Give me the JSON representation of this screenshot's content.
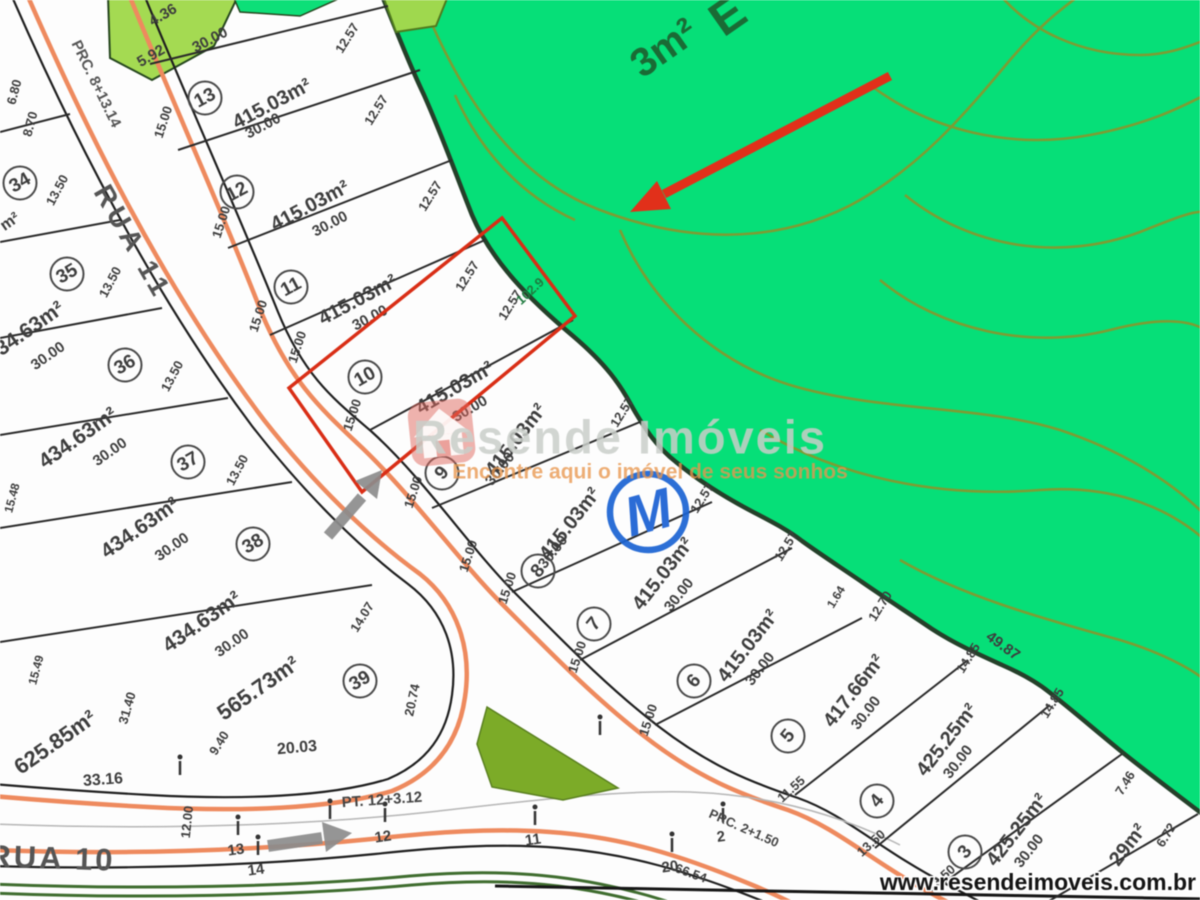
{
  "footer": {
    "url": "www.resendeimoveis.com.br"
  },
  "watermark": {
    "brand": "Resende Imóveis",
    "tagline": "Encontre aqui o imóvel de seus sonhos",
    "icon": "house-icon"
  },
  "colors": {
    "preserve_green": "#06DF78",
    "light_green_lot": "#A4DA52",
    "contour_olive": "#7E9C33",
    "island_green": "#7CAB28",
    "road_salmon": "#EE8A5E",
    "highlight_red": "#D92E16",
    "marker_blue": "#1A63D2",
    "arrow_gray": "#8C8C8C"
  },
  "map": {
    "streets": [
      {
        "name": "RUA 11"
      },
      {
        "name": "RUA 10"
      }
    ],
    "stations": [
      {
        "text": "PRC. 8+13.14"
      },
      {
        "text": "PT. 12+3.12"
      },
      {
        "text": "PRC. 2+1.50"
      }
    ],
    "green_labels": {
      "letter": "E",
      "fragment": "3m²",
      "frontage": "102.9"
    },
    "monument_label": "M",
    "lots": [
      {
        "num": "13",
        "area": "415.03m²",
        "circle": {
          "x": 205,
          "y": 98,
          "rot": -28
        },
        "label": {
          "x": 272,
          "y": 104,
          "rot": -28,
          "s": 20
        }
      },
      {
        "num": "12",
        "area": "415.03m²",
        "circle": {
          "x": 237,
          "y": 192,
          "rot": -28
        },
        "label": {
          "x": 310,
          "y": 206,
          "rot": -28,
          "s": 20
        }
      },
      {
        "num": "11",
        "area": "415.03m²",
        "circle": {
          "x": 291,
          "y": 287,
          "rot": -28
        },
        "label": {
          "x": 358,
          "y": 300,
          "rot": -28,
          "s": 20
        }
      },
      {
        "num": "10",
        "area": "415.03m²",
        "circle": {
          "x": 365,
          "y": 377,
          "rot": -30
        },
        "label": {
          "x": 455,
          "y": 388,
          "rot": -30,
          "s": 20
        }
      },
      {
        "num": "9",
        "area": "415.03m²",
        "circle": {
          "x": 442,
          "y": 473,
          "rot": -50
        },
        "label": {
          "x": 516,
          "y": 440,
          "rot": -52,
          "s": 20
        }
      },
      {
        "num": "8",
        "area": "415.03m²",
        "circle": {
          "x": 538,
          "y": 571,
          "rot": -50
        },
        "label": {
          "x": 570,
          "y": 524,
          "rot": -52,
          "s": 20
        }
      },
      {
        "num": "7",
        "area": "415.03m²",
        "circle": {
          "x": 594,
          "y": 624,
          "rot": -50
        },
        "label": {
          "x": 663,
          "y": 574,
          "rot": -52,
          "s": 20
        }
      },
      {
        "num": "6",
        "area": "415.03m²",
        "circle": {
          "x": 694,
          "y": 681,
          "rot": -50
        },
        "label": {
          "x": 748,
          "y": 646,
          "rot": -52,
          "s": 20
        }
      },
      {
        "num": "5",
        "area": "417.66m²",
        "circle": {
          "x": 788,
          "y": 736,
          "rot": -50
        },
        "label": {
          "x": 854,
          "y": 691,
          "rot": -52,
          "s": 20
        }
      },
      {
        "num": "4",
        "area": "425.25m²",
        "circle": {
          "x": 877,
          "y": 801,
          "rot": -50
        },
        "label": {
          "x": 947,
          "y": 740,
          "rot": -52,
          "s": 20
        }
      },
      {
        "num": "3",
        "area": "425.25m²",
        "circle": {
          "x": 965,
          "y": 852,
          "rot": -50
        },
        "label": {
          "x": 1017,
          "y": 830,
          "rot": -52,
          "s": 20
        }
      },
      {
        "num": "34",
        "area": "",
        "circle": {
          "x": 20,
          "y": 183,
          "rot": -30
        },
        "label": null
      },
      {
        "num": "35",
        "area": "434.63m²",
        "circle": {
          "x": 67,
          "y": 274,
          "rot": -30
        },
        "label": {
          "x": 25,
          "y": 332,
          "rot": -35,
          "s": 21
        }
      },
      {
        "num": "36",
        "area": "434.63m²",
        "circle": {
          "x": 125,
          "y": 365,
          "rot": -30
        },
        "label": {
          "x": 78,
          "y": 438,
          "rot": -35,
          "s": 21
        }
      },
      {
        "num": "37",
        "area": "434.63m²",
        "circle": {
          "x": 188,
          "y": 462,
          "rot": -30
        },
        "label": {
          "x": 140,
          "y": 528,
          "rot": -35,
          "s": 21
        }
      },
      {
        "num": "38",
        "area": "434.63m²",
        "circle": {
          "x": 253,
          "y": 544,
          "rot": -30
        },
        "label": {
          "x": 202,
          "y": 622,
          "rot": -35,
          "s": 21
        }
      },
      {
        "num": "39",
        "area": "565.73m²",
        "circle": {
          "x": 360,
          "y": 681,
          "rot": -30
        },
        "label": {
          "x": 258,
          "y": 688,
          "rot": -35,
          "s": 22
        }
      }
    ],
    "extra_areas": [
      {
        "t": "625.85m²",
        "x": 55,
        "y": 742,
        "r": -35,
        "s": 22
      },
      {
        "t": "29m²",
        "x": 1128,
        "y": 845,
        "r": -52,
        "s": 20
      },
      {
        "t": "m²",
        "x": 10,
        "y": 222,
        "r": -35,
        "s": 16
      }
    ],
    "measurements": [
      {
        "t": "15.00",
        "x": 163,
        "y": 122,
        "r": -72
      },
      {
        "t": "15.00",
        "x": 221,
        "y": 222,
        "r": -72
      },
      {
        "t": "15.00",
        "x": 258,
        "y": 316,
        "r": -72
      },
      {
        "t": "15.00",
        "x": 297,
        "y": 347,
        "r": -72
      },
      {
        "t": "15.00",
        "x": 352,
        "y": 415,
        "r": -72
      },
      {
        "t": "15.00",
        "x": 413,
        "y": 492,
        "r": -72
      },
      {
        "t": "15.00",
        "x": 468,
        "y": 556,
        "r": -72
      },
      {
        "t": "15.00",
        "x": 507,
        "y": 588,
        "r": -72
      },
      {
        "t": "15.00",
        "x": 577,
        "y": 657,
        "r": -72
      },
      {
        "t": "15.00",
        "x": 648,
        "y": 720,
        "r": -72
      },
      {
        "t": "13.50",
        "x": 57,
        "y": 190,
        "r": -62
      },
      {
        "t": "13.50",
        "x": 110,
        "y": 282,
        "r": -62
      },
      {
        "t": "13.50",
        "x": 172,
        "y": 376,
        "r": -62
      },
      {
        "t": "13.50",
        "x": 237,
        "y": 470,
        "r": -62
      },
      {
        "t": "12.57",
        "x": 347,
        "y": 38,
        "r": -58
      },
      {
        "t": "12.57",
        "x": 376,
        "y": 110,
        "r": -58
      },
      {
        "t": "12.57",
        "x": 430,
        "y": 196,
        "r": -58
      },
      {
        "t": "12.57",
        "x": 467,
        "y": 276,
        "r": -58
      },
      {
        "t": "12.57",
        "x": 510,
        "y": 305,
        "r": -58
      },
      {
        "t": "12.57",
        "x": 622,
        "y": 412,
        "r": -58
      },
      {
        "t": "12.57",
        "x": 702,
        "y": 498,
        "r": -58
      },
      {
        "t": "12.57",
        "x": 786,
        "y": 546,
        "r": -58
      },
      {
        "t": "1.64",
        "x": 836,
        "y": 597,
        "r": -58,
        "s": 12
      },
      {
        "t": "12.70",
        "x": 880,
        "y": 606,
        "r": -58
      },
      {
        "t": "14.85",
        "x": 968,
        "y": 658,
        "r": -58
      },
      {
        "t": "14.85",
        "x": 1052,
        "y": 703,
        "r": -58
      },
      {
        "t": "7.46",
        "x": 1125,
        "y": 783,
        "r": -58
      },
      {
        "t": "6.72",
        "x": 1166,
        "y": 835,
        "r": -58
      },
      {
        "t": "49.87",
        "x": 1003,
        "y": 646,
        "r": 36,
        "s": 15
      },
      {
        "t": "30.00",
        "x": 210,
        "y": 40,
        "r": -28,
        "s": 15
      },
      {
        "t": "30.00",
        "x": 263,
        "y": 126,
        "r": -28,
        "s": 15
      },
      {
        "t": "30.00",
        "x": 330,
        "y": 224,
        "r": -28,
        "s": 15
      },
      {
        "t": "30.00",
        "x": 370,
        "y": 318,
        "r": -28,
        "s": 15
      },
      {
        "t": "30.00",
        "x": 470,
        "y": 409,
        "r": -30,
        "s": 15
      },
      {
        "t": "30.00",
        "x": 500,
        "y": 469,
        "r": -52,
        "s": 15
      },
      {
        "t": "30.00",
        "x": 553,
        "y": 552,
        "r": -52,
        "s": 15
      },
      {
        "t": "30.00",
        "x": 679,
        "y": 595,
        "r": -52,
        "s": 15
      },
      {
        "t": "30.00",
        "x": 760,
        "y": 669,
        "r": -52,
        "s": 15
      },
      {
        "t": "30.00",
        "x": 866,
        "y": 713,
        "r": -52,
        "s": 15
      },
      {
        "t": "30.00",
        "x": 958,
        "y": 762,
        "r": -52,
        "s": 15
      },
      {
        "t": "30.00",
        "x": 1029,
        "y": 851,
        "r": -52,
        "s": 15
      },
      {
        "t": "30.00",
        "x": 48,
        "y": 356,
        "r": -35,
        "s": 15
      },
      {
        "t": "30.00",
        "x": 110,
        "y": 452,
        "r": -35,
        "s": 15
      },
      {
        "t": "30.00",
        "x": 172,
        "y": 547,
        "r": -35,
        "s": 15
      },
      {
        "t": "30.00",
        "x": 232,
        "y": 643,
        "r": -35,
        "s": 15
      },
      {
        "t": "33.16",
        "x": 103,
        "y": 780,
        "r": -4,
        "s": 16
      },
      {
        "t": "20.03",
        "x": 297,
        "y": 748,
        "r": -5,
        "s": 16
      },
      {
        "t": "20.74",
        "x": 412,
        "y": 700,
        "r": -78
      },
      {
        "t": "31.40",
        "x": 127,
        "y": 708,
        "r": -74
      },
      {
        "t": "9.40",
        "x": 219,
        "y": 743,
        "r": -58
      },
      {
        "t": "14.07",
        "x": 362,
        "y": 617,
        "r": -58
      },
      {
        "t": "11.55",
        "x": 791,
        "y": 789,
        "r": -42
      },
      {
        "t": "13.50",
        "x": 871,
        "y": 843,
        "r": -42
      },
      {
        "t": "13.50",
        "x": 941,
        "y": 878,
        "r": -42
      },
      {
        "t": "12.00",
        "x": 187,
        "y": 822,
        "r": -84
      },
      {
        "t": "66.54",
        "x": 691,
        "y": 873,
        "r": 20
      },
      {
        "t": "4.36",
        "x": 163,
        "y": 15,
        "r": -30,
        "s": 15
      },
      {
        "t": "5.92",
        "x": 151,
        "y": 56,
        "r": -30,
        "s": 15
      },
      {
        "t": "6.80",
        "x": 14,
        "y": 92,
        "r": -75,
        "s": 13
      },
      {
        "t": "8.70",
        "x": 30,
        "y": 124,
        "r": -75,
        "s": 13
      },
      {
        "t": "15.48",
        "x": 12,
        "y": 498,
        "r": -75,
        "s": 12
      },
      {
        "t": "15.49",
        "x": 36,
        "y": 670,
        "r": -75,
        "s": 12
      }
    ],
    "ticks": [
      {
        "x": 180,
        "y": 768,
        "t": ""
      },
      {
        "x": 385,
        "y": 815,
        "t": "12"
      },
      {
        "x": 535,
        "y": 818,
        "t": "11"
      },
      {
        "x": 238,
        "y": 828,
        "t": "13"
      },
      {
        "x": 258,
        "y": 848,
        "t": "14"
      },
      {
        "x": 723,
        "y": 815,
        "t": "2"
      },
      {
        "x": 672,
        "y": 845,
        "t": "20"
      },
      {
        "x": 600,
        "y": 728,
        "t": ""
      },
      {
        "x": 330,
        "y": 812,
        "t": ""
      }
    ]
  }
}
